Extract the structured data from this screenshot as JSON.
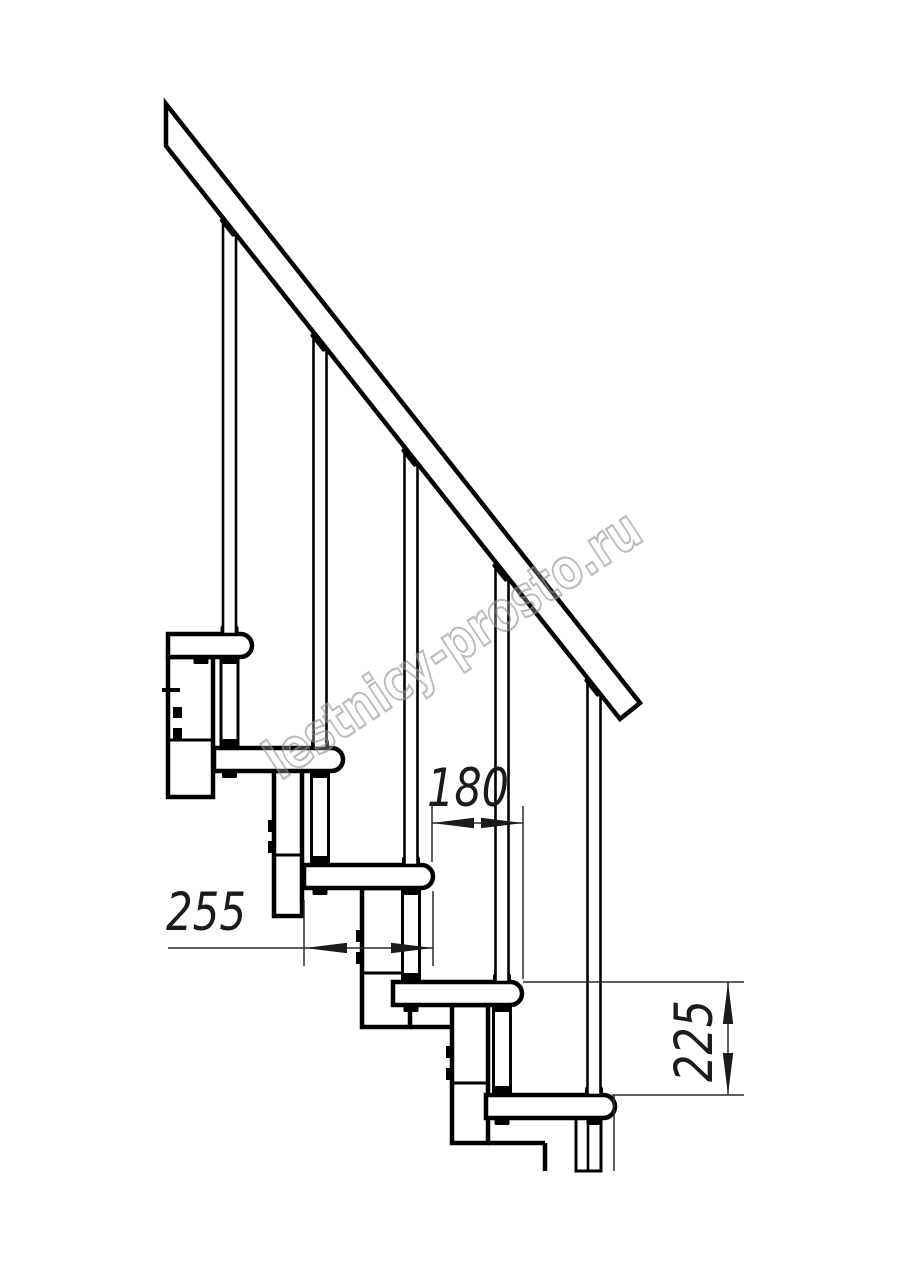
{
  "watermark": {
    "text": "lestnicy-prosto.ru",
    "stroke_color": "#8d8d8d",
    "angle_deg": -33.5
  },
  "dims": [
    {
      "label": "180",
      "meaning": "step-run",
      "text_pos": [
        468,
        806
      ],
      "rotate": 0,
      "text_len": 82,
      "line": [
        432,
        823,
        523,
        823
      ],
      "arrows": [
        [
          432,
          823,
          180
        ],
        [
          523,
          823,
          0
        ]
      ],
      "exts": [
        [
          432,
          806,
          432,
          862
        ],
        [
          523,
          806,
          523,
          979
        ]
      ]
    },
    {
      "label": "255",
      "meaning": "tread-depth",
      "text_pos": [
        206,
        930
      ],
      "rotate": 0,
      "text_len": 80,
      "line": [
        168,
        948,
        433,
        948
      ],
      "arrows": [
        [
          305,
          948,
          180
        ],
        [
          433,
          948,
          0
        ]
      ],
      "exts": [
        [
          304,
          900,
          304,
          966
        ],
        [
          433,
          891,
          433,
          966
        ]
      ]
    },
    {
      "label": "225",
      "meaning": "step-rise",
      "text_pos": [
        712,
        1041
      ],
      "rotate": -90,
      "text_len": 82,
      "line": [
        728,
        982,
        728,
        1095
      ],
      "arrows": [
        [
          728,
          982,
          -90
        ],
        [
          728,
          1095,
          90
        ]
      ],
      "exts": [
        [
          523,
          982,
          744,
          982
        ],
        [
          612,
          1095,
          744,
          1095
        ],
        [
          614,
          1095,
          614,
          1171
        ]
      ]
    }
  ],
  "drawing": {
    "canvas": {
      "w": 914,
      "h": 1280,
      "bg": "#ffffff"
    },
    "style": {
      "ink": "#000000",
      "dim_ink": "#1b1b1b",
      "hair": "#2b2b2b",
      "thick": 4.5,
      "medium": 3,
      "slim": 2.6,
      "hairline": 1.5,
      "wm_fill": "#ffffff",
      "wm_fill_opacity": 0.25,
      "wm_stroke_opacity": 0.6
    },
    "rail": {
      "points": "166,104 640,703 620,719 166,146"
    },
    "tread_h": 23,
    "tread_r": 11.5,
    "treads": [
      {
        "left": 168,
        "top": 634,
        "nose": 252
      },
      {
        "left": 214,
        "top": 748,
        "nose": 343
      },
      {
        "left": 304,
        "top": 865,
        "nose": 433
      },
      {
        "left": 393,
        "top": 982,
        "nose": 522
      },
      {
        "left": 486,
        "top": 1095,
        "nose": 615
      }
    ],
    "baluster_w": 13,
    "balusters": [
      {
        "cx": 229.5,
        "top": 225
      },
      {
        "cx": 320,
        "top": 340
      },
      {
        "cx": 411,
        "top": 455
      },
      {
        "cx": 502,
        "top": 570
      },
      {
        "cx": 594,
        "top": 685
      }
    ],
    "cap_angle": 51.6,
    "cap_w": 22,
    "cap_h": 9,
    "tube_w": 17,
    "tubes": [
      {
        "cx": 229.5,
        "top": 657,
        "bottom": 748
      },
      {
        "cx": 320,
        "top": 771,
        "bottom": 865
      },
      {
        "cx": 411,
        "top": 888,
        "bottom": 982
      },
      {
        "cx": 502,
        "top": 1005,
        "bottom": 1095
      }
    ],
    "stub": {
      "x": 576,
      "top": 1118,
      "w": 25,
      "bottom": 1171,
      "inner_x": 588,
      "inner_w": 13
    },
    "on_tread_blobs": [
      [
        229.5
      ],
      [
        229.5,
        320
      ],
      [
        320,
        411
      ],
      [
        411,
        502
      ],
      [
        502,
        594
      ]
    ],
    "under_tread_nubs": [
      [
        201,
        229.5
      ],
      [
        229.5,
        320
      ],
      [
        320,
        411
      ],
      [
        411,
        502
      ],
      [
        502,
        594
      ]
    ],
    "bolt_w": 8,
    "bolt_h": 12,
    "boxes": [
      {
        "x": 168,
        "top": 657,
        "w": 45,
        "bottom": 797,
        "mid": 740
      },
      {
        "x": 274,
        "top": 770,
        "w": 28,
        "bottom": 916,
        "mid": 855,
        "bolts": [
          820,
          841
        ]
      },
      {
        "x": 362,
        "top": 888,
        "w": 48,
        "bottom": 1027,
        "mid": 973,
        "bolts": [
          930,
          952
        ],
        "ext_lines": [
          [
            410,
            1027,
            452,
            1027
          ]
        ]
      },
      {
        "x": 452,
        "top": 1005,
        "w": 36,
        "bottom": 1143,
        "mid": 1083,
        "bolts": [
          1046,
          1068
        ],
        "ext_lines": [
          [
            488,
            1143,
            545,
            1143
          ],
          [
            545,
            1143,
            545,
            1171
          ]
        ]
      }
    ],
    "box1_extra": {
      "tick": [
        162,
        688,
        18,
        4
      ],
      "squares": [
        [
          173,
          707,
          9,
          11
        ],
        [
          173,
          728,
          9,
          11
        ]
      ]
    }
  }
}
